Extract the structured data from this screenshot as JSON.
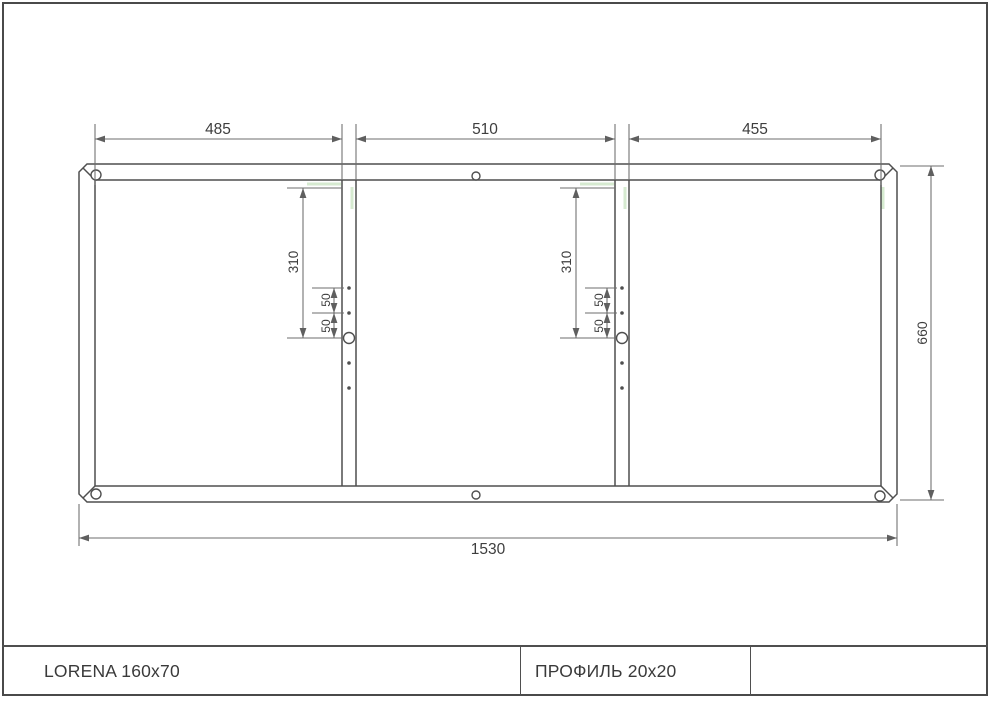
{
  "colors": {
    "line": "#4f4f4f",
    "dim": "#6d6d6d",
    "text": "#3e3e3e",
    "weld_mark": "#cfe7c8",
    "sheet_border": "#4a4a4a"
  },
  "dims": {
    "top": [
      {
        "label": "485"
      },
      {
        "label": "510"
      },
      {
        "label": "455"
      }
    ],
    "bottom": {
      "label": "1530"
    },
    "side": {
      "label": "660"
    },
    "members": [
      {
        "offset": {
          "label": "310"
        },
        "spacing": [
          {
            "label": "50"
          },
          {
            "label": "50"
          }
        ]
      },
      {
        "offset": {
          "label": "310"
        },
        "spacing": [
          {
            "label": "50"
          },
          {
            "label": "50"
          }
        ]
      }
    ]
  },
  "title_block": {
    "cells": [
      {
        "label": "LORENA 160x70"
      },
      {
        "label": "ПРОФИЛЬ 20x20"
      },
      {
        "label": ""
      }
    ]
  }
}
